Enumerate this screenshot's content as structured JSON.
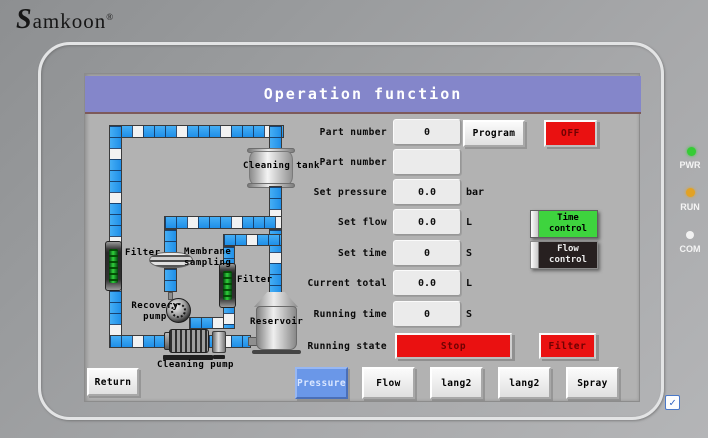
{
  "brand": {
    "logo_s": "S",
    "logo_rest": "amkoon",
    "reg": "®"
  },
  "leds": [
    {
      "label": "PWR",
      "color": "#35cc35"
    },
    {
      "label": "RUN",
      "color": "#e2a224"
    },
    {
      "label": "COM",
      "color": "#f2f2f2"
    }
  ],
  "screen": {
    "title": "Operation function",
    "rows": [
      {
        "label": "Part number",
        "value": "0",
        "unit": ""
      },
      {
        "label": "Part number",
        "value": "",
        "unit": ""
      },
      {
        "label": "Set pressure",
        "value": "0.0",
        "unit": "bar"
      },
      {
        "label": "Set flow",
        "value": "0.0",
        "unit": "L"
      },
      {
        "label": "Set time",
        "value": "0",
        "unit": "S"
      },
      {
        "label": "Current total",
        "value": "0.0",
        "unit": "L"
      },
      {
        "label": "Running time",
        "value": "0",
        "unit": "S"
      },
      {
        "label": "Running state",
        "value": "",
        "unit": ""
      }
    ],
    "buttons": {
      "program": "Program",
      "power": "OFF",
      "time_control": "Time control",
      "flow_control": "Flow control",
      "running_state": "Stop",
      "filter_mode": "Filter"
    },
    "nav": [
      {
        "label": "Return"
      },
      {
        "label": "Pressure"
      },
      {
        "label": "Flow"
      },
      {
        "label": "lang2"
      },
      {
        "label": "lang2"
      },
      {
        "label": "Spray"
      }
    ],
    "diagram": {
      "cleaning_tank": "Cleaning tank",
      "filter_left": "Filter",
      "membrane_line1": "Membrane",
      "membrane_line2": "sampling",
      "filter_right": "Filter",
      "recovery_line1": "Recovery",
      "recovery_line2": "pump",
      "reservoir": "Reservoir",
      "cleaning_pump": "Cleaning pump"
    }
  },
  "colors": {
    "title_purple": "#8486ca",
    "pipe_blue": "#2e9ff2",
    "alarm_red": "#ea1111",
    "ok_green": "#3ed43e",
    "nav_blue": "#6a97e8"
  },
  "corner": {
    "check": "✓"
  }
}
